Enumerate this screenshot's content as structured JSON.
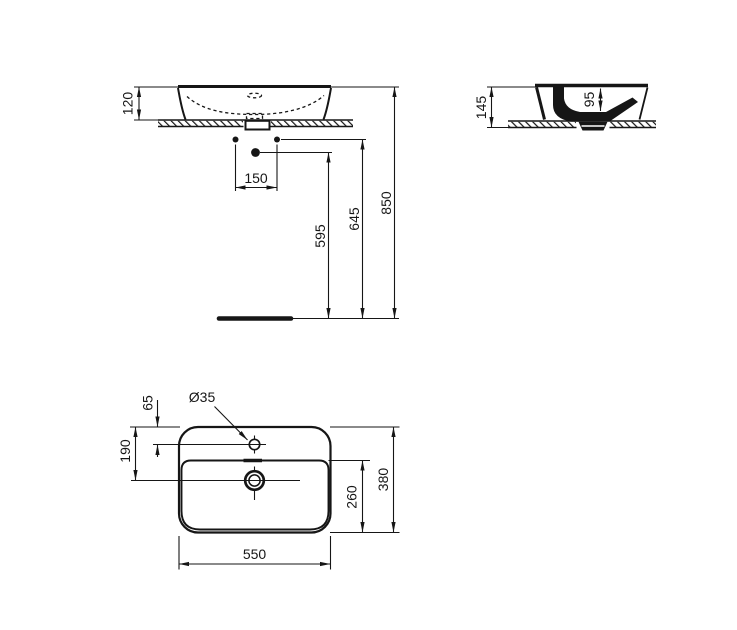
{
  "drawing": {
    "type": "technical-dimension-drawing",
    "subject": "countertop washbasin",
    "line_color": "#161616",
    "background_color": "#ffffff"
  },
  "views": {
    "front": {
      "name": "front elevation",
      "dimensions": {
        "basin_height": "120",
        "fixing_hole_spacing": "150",
        "drain_outlet_height": "595",
        "fixing_holes_height": "645",
        "rim_height": "850"
      }
    },
    "side": {
      "name": "side section",
      "dimensions": {
        "total_height": "145",
        "bowl_depth": "95"
      }
    },
    "plan": {
      "name": "plan view",
      "dimensions": {
        "tap_hole_offset": "65",
        "drain_offset": "190",
        "bowl_front_to_back": "260",
        "overall_depth": "380",
        "overall_width": "550",
        "tap_hole_diameter": "Ø35"
      }
    }
  }
}
